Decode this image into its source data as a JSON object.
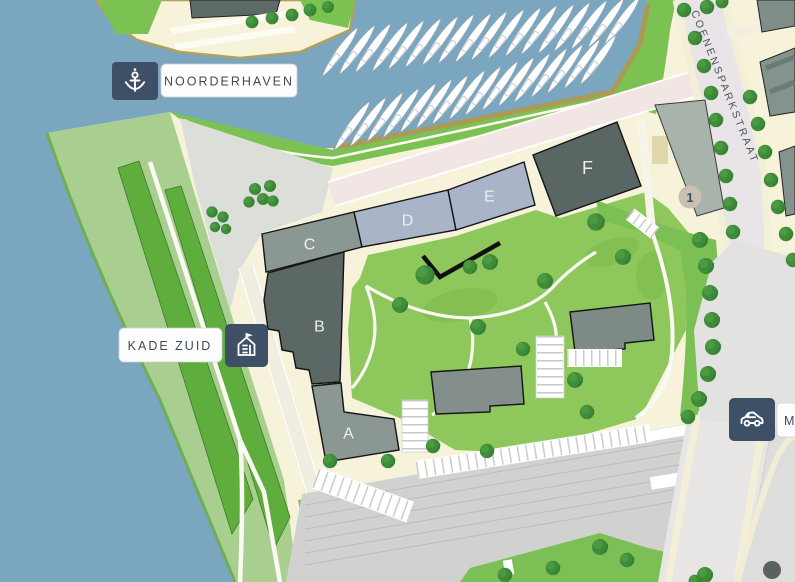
{
  "markers": {
    "noorderhaven": {
      "label": "NOORDERHAVEN",
      "icon": "anchor"
    },
    "kade_zuid": {
      "label": "KADE ZUID",
      "icon": "building"
    },
    "station": {
      "label": "M",
      "icon": "car"
    }
  },
  "street_name": "COENENSPARKSTRAAT",
  "buildings": {
    "a": "A",
    "b": "B",
    "c": "C",
    "d": "D",
    "e": "E",
    "f": "F"
  },
  "badge": {
    "number": "1"
  },
  "colors": {
    "water": "#7ba6bf",
    "land": "#f6f3da",
    "grass_light": "#a9cf90",
    "grass": "#7cc253",
    "grass_dark": "#5fae3d",
    "courtyard": "#8ec85c",
    "tree": "#3e8b3a",
    "navy": "#3d5066",
    "building_dark": "#5c6865",
    "building_gray": "#8a9793",
    "building_blue": "#aab4c8",
    "plaza": "#dcdeda",
    "railway": "#d1d1d0",
    "dock": "#ab9a55",
    "walkway_pink": "#f2e6e4",
    "badge_fill": "#c9bfb2",
    "label_text": "#3d4b57"
  }
}
